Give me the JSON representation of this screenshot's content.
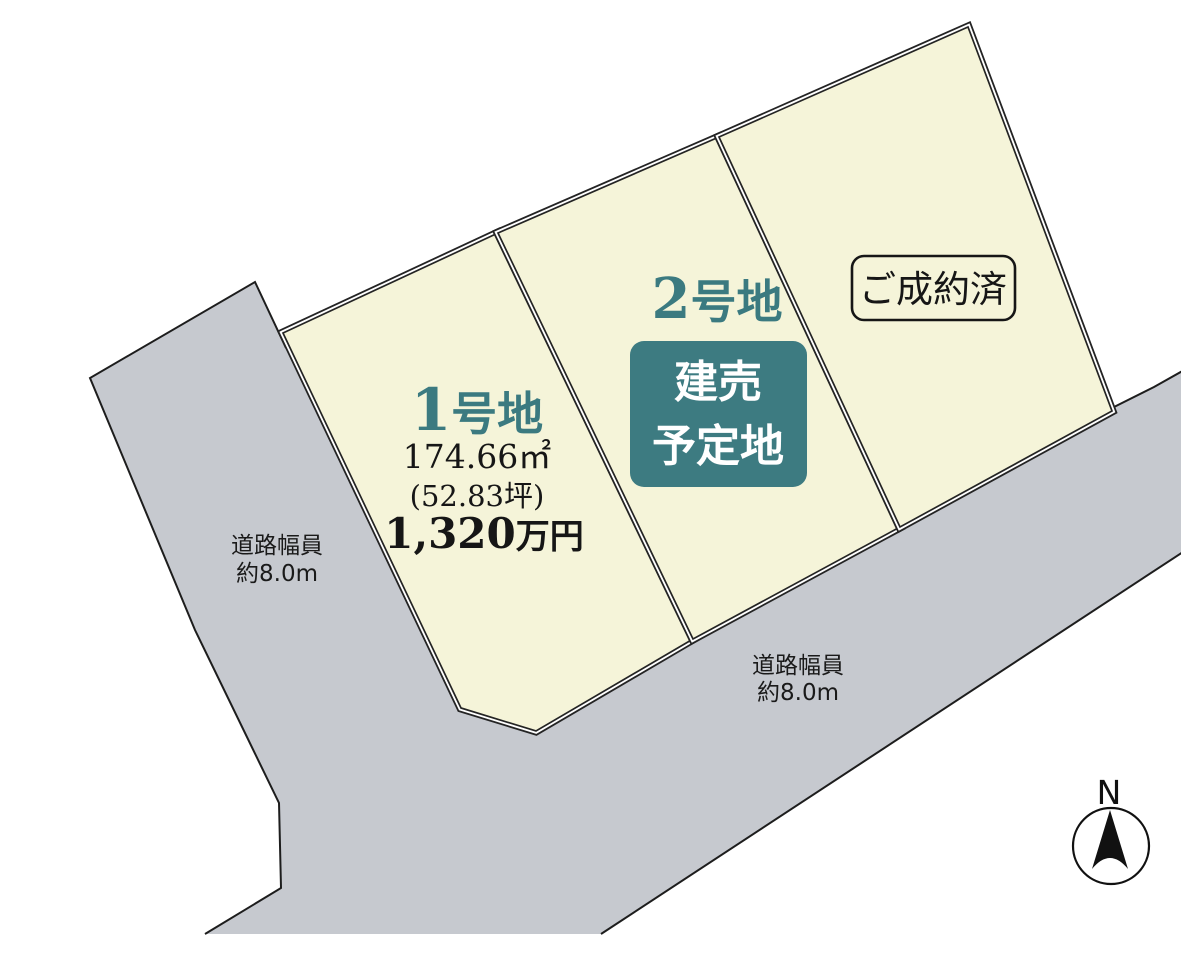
{
  "colors": {
    "background": "#ffffff",
    "lot_fill": "#f5f4d9",
    "road_fill": "#c6c9cf",
    "outline": "#242424",
    "teal_text": "#3b7a80",
    "teal_box": "#3d7b81",
    "text_dark": "#161616",
    "badge_text": "#ffffff"
  },
  "lots": {
    "lot1": {
      "number": "1",
      "suffix": "号地",
      "area": "174.66㎡",
      "area_tsubo": "(52.83坪)",
      "price_value": "1,320",
      "price_unit": "万円"
    },
    "lot2": {
      "number": "2",
      "suffix": "号地",
      "badge_line1": "建売",
      "badge_line2": "予定地"
    },
    "lot3": {
      "sold_label": "ご成約済"
    }
  },
  "roads": {
    "left": {
      "label_line1": "道路幅員",
      "label_line2": "約8.0m"
    },
    "bottom": {
      "label_line1": "道路幅員",
      "label_line2": "約8.0m"
    }
  },
  "compass": {
    "north_label": "N"
  }
}
